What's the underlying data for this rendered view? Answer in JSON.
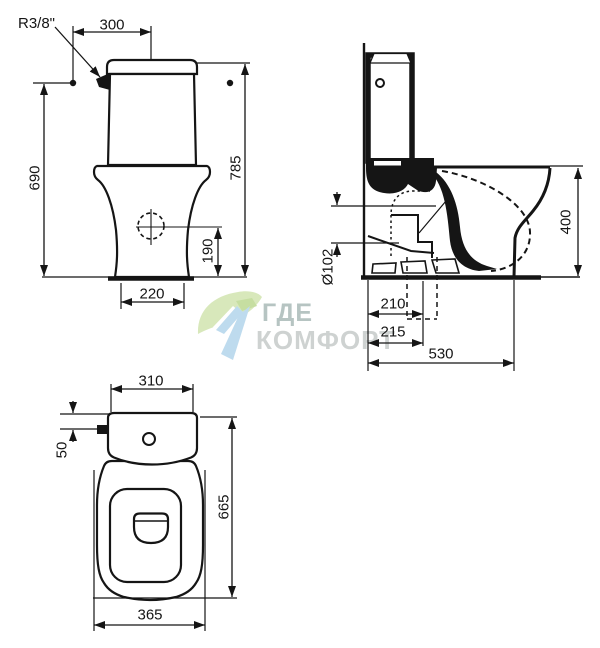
{
  "drawing_type": "toilet-dimension-drawing",
  "views": {
    "front": {
      "label": "front-view",
      "dims": {
        "supply_thread": "R3/8\"",
        "supply_offset": "300",
        "total_height": "785",
        "supply_height": "690",
        "drain_height": "190",
        "base_width": "220"
      }
    },
    "side": {
      "label": "side-view",
      "dims": {
        "bowl_height": "400",
        "outlet_diameter": "Ø102",
        "outlet_offset_a": "210",
        "outlet_offset_b": "215",
        "total_depth": "530"
      }
    },
    "top": {
      "label": "top-view",
      "dims": {
        "tank_width": "310",
        "supply_offset": "50",
        "total_length": "665",
        "bowl_width": "365"
      }
    }
  },
  "watermark": {
    "line1": "ГДЕ",
    "line2": "КОМФОРТ"
  },
  "colors": {
    "line": "#151515",
    "watermark_text_primary": "#a4b6b4",
    "watermark_text_secondary": "#c3c8c6",
    "watermark_green": "#cfe3ab",
    "watermark_green_dark": "#b9d78a",
    "watermark_blue": "#aed3ea"
  }
}
